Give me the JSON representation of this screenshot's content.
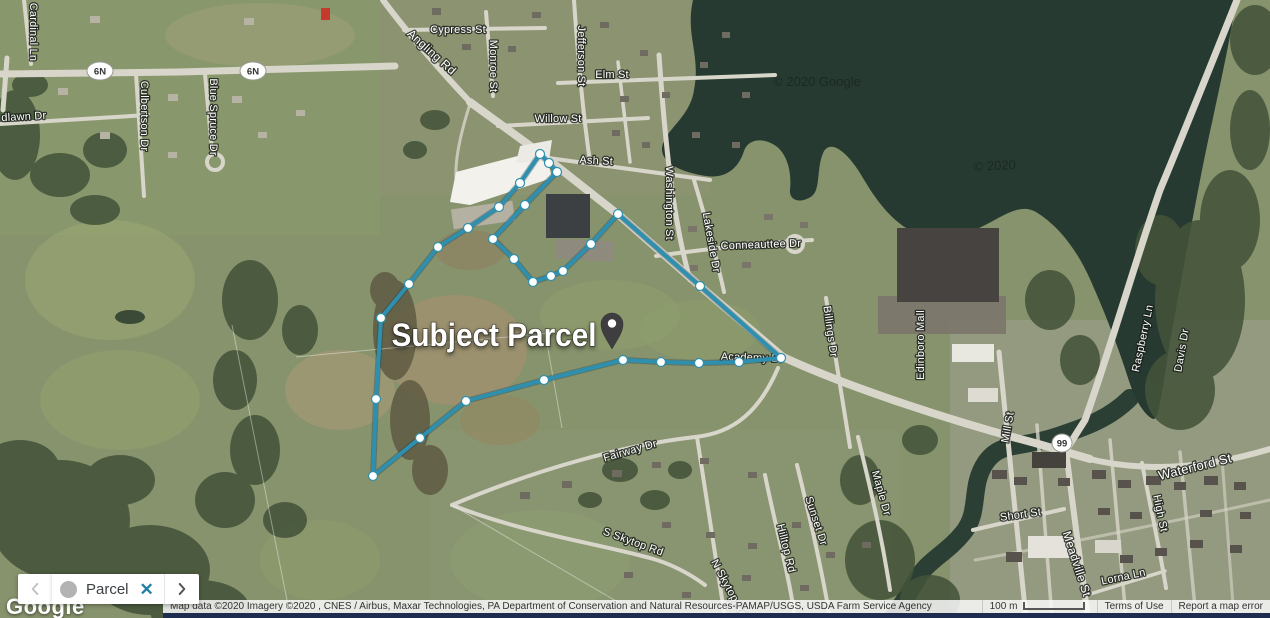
{
  "map": {
    "parcel": {
      "label": "Subject Parcel",
      "line_color": "#2e90ae",
      "vertices": [
        [
          540,
          154
        ],
        [
          549,
          163
        ],
        [
          557,
          172
        ],
        [
          525,
          205
        ],
        [
          493,
          239
        ],
        [
          514,
          259
        ],
        [
          533,
          282
        ],
        [
          551,
          276
        ],
        [
          563,
          271
        ],
        [
          591,
          244
        ],
        [
          618,
          214
        ],
        [
          700,
          286
        ],
        [
          781,
          358
        ],
        [
          739,
          362
        ],
        [
          699,
          363
        ],
        [
          661,
          362
        ],
        [
          623,
          360
        ],
        [
          544,
          380
        ],
        [
          466,
          401
        ],
        [
          420,
          438
        ],
        [
          373,
          476
        ],
        [
          376,
          399
        ],
        [
          381,
          318
        ],
        [
          409,
          284
        ],
        [
          438,
          247
        ],
        [
          468,
          228
        ],
        [
          499,
          207
        ],
        [
          520,
          183
        ]
      ],
      "marker": {
        "x": 612,
        "y": 330
      }
    },
    "street_labels": [
      {
        "text": "Cardinal Ln",
        "x": 30,
        "y": 32,
        "r": 90
      },
      {
        "text": "dlawn Dr",
        "x": 24,
        "y": 120,
        "r": -3
      },
      {
        "text": "Culbertson Dr",
        "x": 141,
        "y": 116,
        "r": 90
      },
      {
        "text": "Blue Spruce Dr",
        "x": 210,
        "y": 117,
        "r": 90
      },
      {
        "text": "Angling Rd",
        "x": 429,
        "y": 55,
        "r": 42,
        "s": 12
      },
      {
        "text": "Cypress St",
        "x": 458,
        "y": 33,
        "r": 0
      },
      {
        "text": "Monroe St",
        "x": 490,
        "y": 66,
        "r": 90
      },
      {
        "text": "Jefferson St",
        "x": 578,
        "y": 56,
        "r": 90
      },
      {
        "text": "Elm St",
        "x": 612,
        "y": 78,
        "r": 0
      },
      {
        "text": "Willow St",
        "x": 558,
        "y": 122,
        "r": 0
      },
      {
        "text": "Ash St",
        "x": 596,
        "y": 164,
        "r": 3
      },
      {
        "text": "Washington St",
        "x": 666,
        "y": 203,
        "r": 90
      },
      {
        "text": "Lakeside Dr",
        "x": 708,
        "y": 243,
        "r": 80
      },
      {
        "text": "Conneauttee Dr",
        "x": 761,
        "y": 248,
        "r": -2
      },
      {
        "text": "Billings Dr",
        "x": 827,
        "y": 332,
        "r": 82
      },
      {
        "text": "Edinboro Mall",
        "x": 924,
        "y": 345,
        "r": -90
      },
      {
        "text": "Academy Dr",
        "x": 752,
        "y": 361,
        "r": 2,
        "u": true
      },
      {
        "text": "Raspberry Ln",
        "x": 1146,
        "y": 339,
        "r": -78
      },
      {
        "text": "Davis Dr",
        "x": 1185,
        "y": 351,
        "r": -80
      },
      {
        "text": "Mill St",
        "x": 1011,
        "y": 428,
        "r": -80
      },
      {
        "text": "Waterford St",
        "x": 1196,
        "y": 471,
        "r": -14,
        "s": 13
      },
      {
        "text": "Short St",
        "x": 1021,
        "y": 518,
        "r": -8
      },
      {
        "text": "High St",
        "x": 1157,
        "y": 514,
        "r": 78
      },
      {
        "text": "Meadville St",
        "x": 1073,
        "y": 565,
        "r": 72,
        "s": 12
      },
      {
        "text": "Lorna Ln",
        "x": 1124,
        "y": 580,
        "r": -12
      },
      {
        "text": "Maple Dr",
        "x": 878,
        "y": 494,
        "r": 74
      },
      {
        "text": "Sunset Dr",
        "x": 813,
        "y": 522,
        "r": 72
      },
      {
        "text": "Hilltop Rd",
        "x": 783,
        "y": 549,
        "r": 76
      },
      {
        "text": "N Skytop Rd",
        "x": 726,
        "y": 590,
        "r": 62
      },
      {
        "text": "S Skytop Rd",
        "x": 632,
        "y": 545,
        "r": 20
      },
      {
        "text": "Fairway Dr",
        "x": 631,
        "y": 454,
        "r": -16
      }
    ],
    "route_shields": [
      {
        "text": "6N",
        "x": 100,
        "y": 71
      },
      {
        "text": "6N",
        "x": 253,
        "y": 71
      },
      {
        "text": "99",
        "x": 1062,
        "y": 443
      }
    ],
    "watermarks": [
      {
        "text": "© 2020 Google",
        "x": 817,
        "y": 86,
        "r": 0
      },
      {
        "text": "© 2020",
        "x": 995,
        "y": 170,
        "r": -3
      }
    ]
  },
  "footer": {
    "logo": "Google",
    "chip": {
      "label": "Parcel"
    },
    "attribution": "Map data ©2020 Imagery ©2020 , CNES / Airbus, Maxar Technologies, PA Department of Conservation and Natural Resources-PAMAP/USGS, USDA Farm Service Agency",
    "scale": {
      "label": "100 m"
    },
    "terms": "Terms of Use",
    "report": "Report a map error"
  }
}
